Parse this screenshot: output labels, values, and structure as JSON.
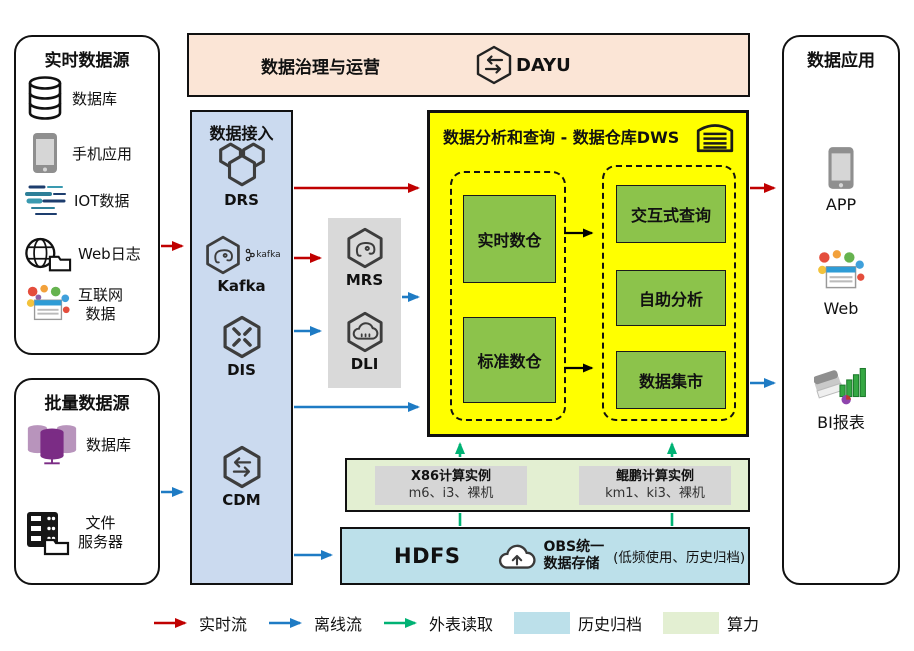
{
  "colors": {
    "red": "#C00000",
    "blue": "#1E7BC4",
    "green": "#00B274",
    "peach": "#FBE5D6",
    "ingest": "#CBDAEF",
    "panel": "#D9D9D9",
    "yellow": "#FFFF00",
    "green_box": "#8CC34B",
    "compute": "#E3EFD2",
    "history": "#BCE0EA"
  },
  "governance": {
    "title": "数据治理与运营",
    "product": "DAYU"
  },
  "realtime_sources": {
    "title": "实时数据源",
    "items": [
      {
        "label": "数据库"
      },
      {
        "label": "手机应用"
      },
      {
        "label": "IOT数据"
      },
      {
        "label": "Web日志"
      },
      {
        "line1": "互联网",
        "line2": "数据"
      }
    ]
  },
  "batch_sources": {
    "title": "批量数据源",
    "items": [
      {
        "label": "数据库"
      },
      {
        "line1": "文件",
        "line2": "服务器"
      }
    ]
  },
  "ingest": {
    "title": "数据接入",
    "items": [
      {
        "label": "DRS"
      },
      {
        "label": "Kafka",
        "badge": "kafka"
      },
      {
        "label": "DIS"
      },
      {
        "label": "CDM"
      }
    ]
  },
  "processing": {
    "items": [
      {
        "label": "MRS"
      },
      {
        "label": "DLI"
      }
    ]
  },
  "dws": {
    "title": "数据分析和查询 - 数据仓库DWS",
    "warehouses": [
      {
        "label": "实时数仓"
      },
      {
        "label": "标准数仓"
      }
    ],
    "services": [
      {
        "label": "交互式查询"
      },
      {
        "label": "自助分析"
      },
      {
        "label": "数据集市"
      }
    ]
  },
  "compute": {
    "instances": [
      {
        "name": "X86计算实例",
        "specs": "m6、i3、裸机"
      },
      {
        "name": "鲲鹏计算实例",
        "specs": "km1、ki3、裸机"
      }
    ]
  },
  "storage": {
    "hdfs": "HDFS",
    "obs_line1": "OBS统一",
    "obs_line2": "数据存储",
    "note": "(低频使用、历史归档)"
  },
  "apps": {
    "title": "数据应用",
    "items": [
      {
        "label": "APP"
      },
      {
        "label": "Web"
      },
      {
        "label": "BI报表"
      }
    ]
  },
  "legend": {
    "items": [
      {
        "label": "实时流"
      },
      {
        "label": "离线流"
      },
      {
        "label": "外表读取"
      },
      {
        "label": "历史归档"
      },
      {
        "label": "算力"
      }
    ]
  }
}
